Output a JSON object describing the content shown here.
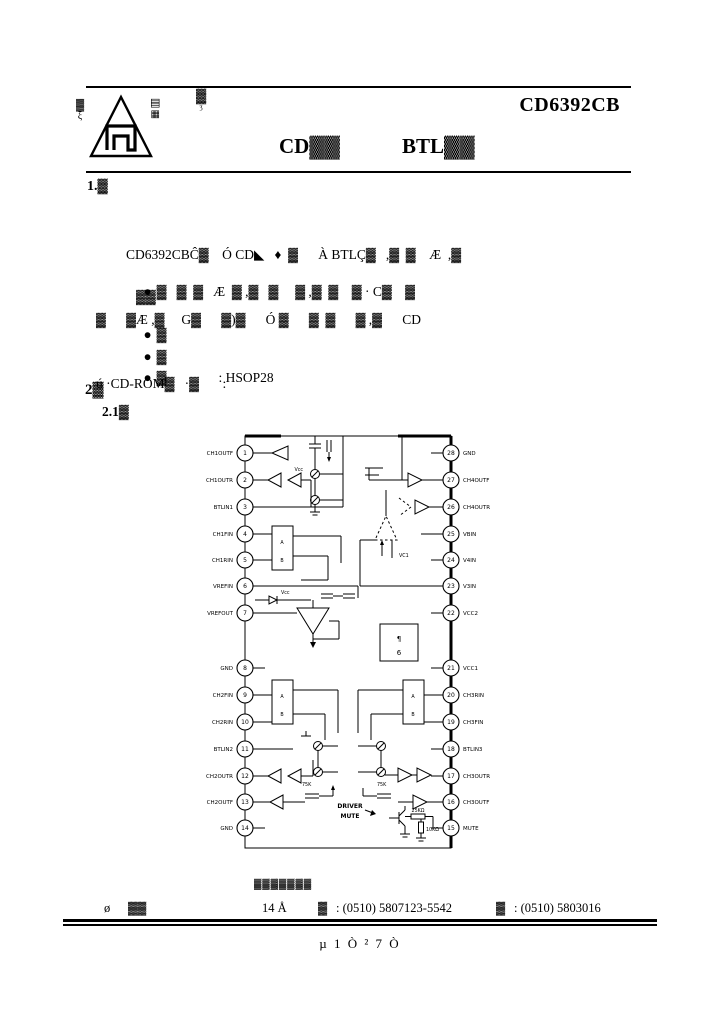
{
  "header": {
    "part_number": "CD6392CB",
    "stamp_top": "▓",
    "stamp_bottom": "ʒ",
    "title_part1": "CD▓▓",
    "title_part2": "BTL▓▓",
    "logo": {
      "left_top": "▓",
      "left_bottom": "ξ",
      "right_top": "▤",
      "right_bottom": "▦"
    }
  },
  "section1": {
    "heading": "1.▓",
    "para_lines": [
      "CD6392CBĈ▓    Ó CD◣   ♦  ▓      À BTLÇ▓   ,▓  ▓    Æ  ,▓",
      "▓      ▓Æ ,▓     G▓      ▓)▓      Ó ▓      ▓  ▓      ▓ ,▓      CD",
      "ú ·CD-ROM▓   ·▓       :"
    ],
    "bullets": [
      {
        "marker": "●",
        "text": "▓   ▓  ▓   Æ  ▓ ,▓   ▓     ▓ ,▓  ▓    ▓ · C▓    ▓",
        "cont": "▓▓"
      },
      {
        "marker": "●",
        "text": "▓"
      },
      {
        "marker": "●",
        "text": "▓"
      },
      {
        "marker": "●",
        "text": "▓",
        "suffix": ": HSOP28"
      }
    ]
  },
  "section2": {
    "heading": "2▓",
    "subheading": "2.1▓"
  },
  "diagram": {
    "left_pins": [
      {
        "n": 1,
        "label": "CH1OUTF"
      },
      {
        "n": 2,
        "label": "CH1OUTR"
      },
      {
        "n": 3,
        "label": "BTLIN1"
      },
      {
        "n": 4,
        "label": "CH1FIN"
      },
      {
        "n": 5,
        "label": "CH1RIN"
      },
      {
        "n": 6,
        "label": "VREFIN"
      },
      {
        "n": 7,
        "label": "VREFOUT"
      },
      {
        "n": 8,
        "label": "GND"
      },
      {
        "n": 9,
        "label": "CH2FIN"
      },
      {
        "n": 10,
        "label": "CH2RIN"
      },
      {
        "n": 11,
        "label": "BTLIN2"
      },
      {
        "n": 12,
        "label": "CH2OUTR"
      },
      {
        "n": 13,
        "label": "CH2OUTF"
      },
      {
        "n": 14,
        "label": "GND"
      }
    ],
    "right_pins": [
      {
        "n": 28,
        "label": "GND"
      },
      {
        "n": 27,
        "label": "CH4OUTF"
      },
      {
        "n": 26,
        "label": "CH4OUTR"
      },
      {
        "n": 25,
        "label": "VBIN"
      },
      {
        "n": 24,
        "label": "V4IN"
      },
      {
        "n": 23,
        "label": "V3IN"
      },
      {
        "n": 22,
        "label": "VCC2"
      },
      {
        "n": 21,
        "label": "VCC1"
      },
      {
        "n": 20,
        "label": "CH3RIN"
      },
      {
        "n": 19,
        "label": "CH3FIN"
      },
      {
        "n": 18,
        "label": "BTLIN3"
      },
      {
        "n": 17,
        "label": "CH3OUTR"
      },
      {
        "n": 16,
        "label": "CH3OUTF"
      },
      {
        "n": 15,
        "label": "MUTE"
      }
    ],
    "labels": {
      "vcc_top": "Vcc",
      "vcc_ref": "Vcc",
      "vc1": "VC1",
      "amp_a": "A",
      "amp_b": "B",
      "center_glyph1": "¶",
      "center_glyph2": "6",
      "driver_line1": "DRIVER",
      "driver_line2": "MUTE",
      "r_25k": "25KΩ",
      "r_10k": "10KΩ",
      "r_75_left": "75K",
      "r_75_right": "75K"
    }
  },
  "footer": {
    "company": "▓▓▓▓▓▓▓",
    "left_mark": "ø",
    "left_blob": "▓▓",
    "address_no": "14 Å",
    "tel_label": "▓",
    "tel": ": (0510) 5807123-5542",
    "fax_label": "▓",
    "fax": ": (0510) 5803016",
    "page_indicator": "µ  1 Ò  ²  7 Ò"
  }
}
